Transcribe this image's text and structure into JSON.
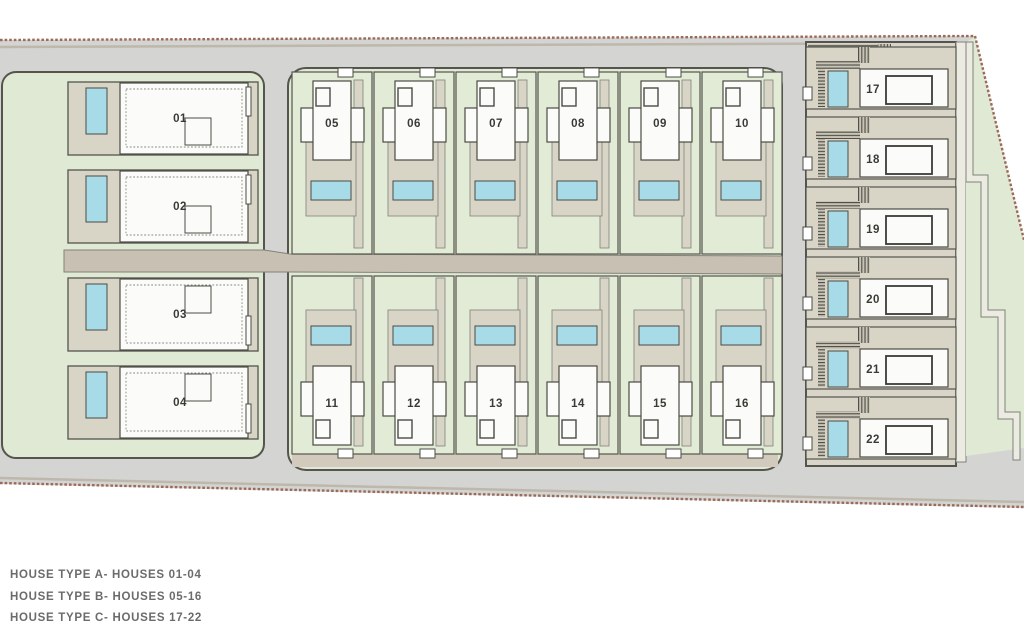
{
  "plan": {
    "legend": [
      "HOUSE TYPE A- HOUSES 01-04",
      "HOUSE TYPE B- HOUSES 05-16",
      "HOUSE TYPE C- HOUSES 17-22"
    ],
    "houses": [
      {
        "number": "01",
        "type": "A"
      },
      {
        "number": "02",
        "type": "A"
      },
      {
        "number": "03",
        "type": "A"
      },
      {
        "number": "04",
        "type": "A"
      },
      {
        "number": "05",
        "type": "B"
      },
      {
        "number": "06",
        "type": "B"
      },
      {
        "number": "07",
        "type": "B"
      },
      {
        "number": "08",
        "type": "B"
      },
      {
        "number": "09",
        "type": "B"
      },
      {
        "number": "10",
        "type": "B"
      },
      {
        "number": "11",
        "type": "B"
      },
      {
        "number": "12",
        "type": "B"
      },
      {
        "number": "13",
        "type": "B"
      },
      {
        "number": "14",
        "type": "B"
      },
      {
        "number": "15",
        "type": "B"
      },
      {
        "number": "16",
        "type": "B"
      },
      {
        "number": "17",
        "type": "C"
      },
      {
        "number": "18",
        "type": "C"
      },
      {
        "number": "19",
        "type": "C"
      },
      {
        "number": "20",
        "type": "C"
      },
      {
        "number": "21",
        "type": "C"
      },
      {
        "number": "22",
        "type": "C"
      }
    ],
    "colors": {
      "road": "#d4d4d2",
      "lawn": "#dfe9d3",
      "plotgreen": "#e1ebd6",
      "terrace": "#d8d4c6",
      "terracec": "#d9d5c8",
      "driveway": "#c8c0b2",
      "sidewalk": "#d2cbbd",
      "pool": "#a8dbe8",
      "house": "#fbfbf9",
      "pale": "#ecebe1",
      "outline": "#55554e",
      "housestroke": "#4c4c45",
      "boundary": "#9b6b5a",
      "wall": "#82827a",
      "ink": "#3b3b36",
      "legendtext": "#6b6b6b"
    }
  }
}
